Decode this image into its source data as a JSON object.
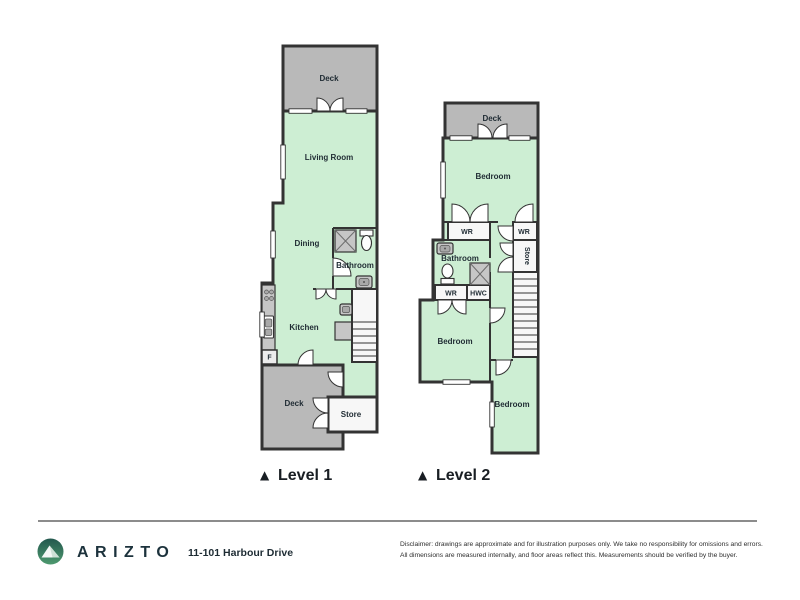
{
  "level1": {
    "marker": "▲",
    "label": "Level 1",
    "rooms": {
      "deck_top": "Deck",
      "living_room": "Living Room",
      "dining": "Dining",
      "bathroom": "Bathroom",
      "kitchen": "Kitchen",
      "fridge": "F",
      "deck_bottom": "Deck",
      "store": "Store"
    }
  },
  "level2": {
    "marker": "▲",
    "label": "Level 2",
    "rooms": {
      "deck": "Deck",
      "bedroom_top": "Bedroom",
      "wr_left": "WR",
      "wr_right": "WR",
      "bathroom": "Bathroom",
      "wr_lower": "WR",
      "hwc": "HWC",
      "store": "Store",
      "bedroom_mid": "Bedroom",
      "bedroom_bottom": "Bedroom"
    }
  },
  "footer": {
    "brand": "ARIZTO",
    "address": "11-101 Harbour Drive",
    "disclaimer_line1": "Disclaimer: drawings are approximate and for illustration purposes only. We take no responsibility for omissions and errors.",
    "disclaimer_line2": "All dimensions are measured internally, and floor areas reflect this. Measurements should be verified by the buyer."
  },
  "colors": {
    "room_fill": "#cdeed3",
    "deck_fill": "#b9b9b9",
    "wall": "#333333",
    "white_room_fill": "#f7f7f7",
    "label_text": "#1f2b33",
    "brand_text": "#1c323c",
    "logo_teal_dark": "#23584e",
    "logo_teal_light": "#4e9a6f",
    "divider_gray": "#8c8c8c"
  }
}
